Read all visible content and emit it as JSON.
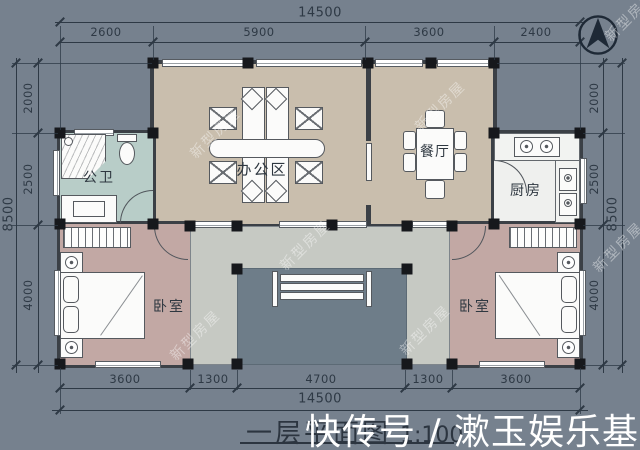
{
  "title": {
    "text": "一层平面图",
    "scale": "1:100"
  },
  "rooms": {
    "office": {
      "label": "办公区"
    },
    "dining": {
      "label": "餐厅"
    },
    "bathroom": {
      "label": "公卫"
    },
    "kitchen": {
      "label": "厨房"
    },
    "bedroom_left": {
      "label": "卧室"
    },
    "bedroom_right": {
      "label": "卧室"
    }
  },
  "dimensions": {
    "top": {
      "total": "14500",
      "segments": [
        "2600",
        "5900",
        "3600",
        "2400"
      ]
    },
    "bottom": {
      "total": "14500",
      "segments": [
        "3600",
        "1300",
        "4700",
        "1300",
        "3600"
      ]
    },
    "left": {
      "total": "8500",
      "segments": [
        "2000",
        "2500",
        "4000"
      ]
    },
    "right": {
      "total": "8500",
      "segments": [
        "2000",
        "2500",
        "4000"
      ]
    }
  },
  "watermarks": {
    "tile": "新型房屋",
    "footer": "快传号 / 漱玉娱乐基地"
  },
  "icons": {
    "compass": "north-arrow-icon"
  },
  "colors": {
    "background": "#76818e",
    "hall_floor": "#c9bead",
    "bedroom_floor": "#c2a8a4",
    "bathroom_floor": "#b8cdc8",
    "kitchen_floor": "#a2b4b3",
    "porch_platform": "#c6c9c3",
    "porch_recess": "#6e7d89",
    "wall": "#3b4046",
    "column": "#16181c",
    "dimension_text": "#2e3945"
  }
}
